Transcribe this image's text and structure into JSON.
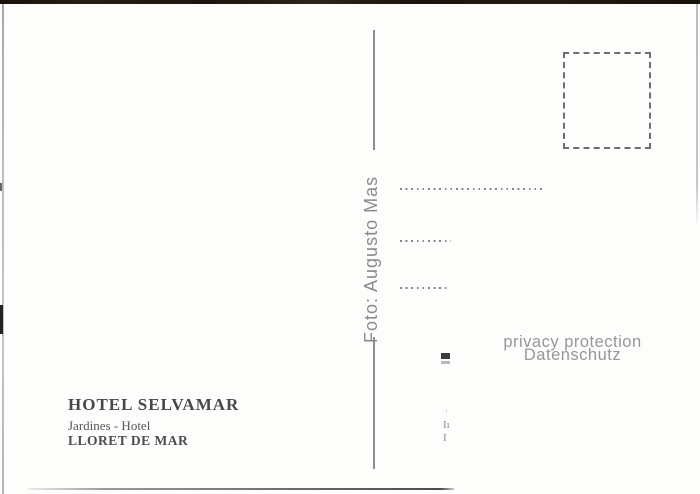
{
  "card": {
    "photographer_credit": "Foto: Augusto Mas",
    "watermark": {
      "line1": "privacy protection",
      "line2": "Datenschutz"
    },
    "caption": {
      "title": "HOTEL SELVAMAR",
      "subtitle": "Jardines - Hotel",
      "location": "LLORET DE MAR"
    },
    "edge_fragments": {
      "f1": "·",
      "f2": "Iı",
      "f3": "I"
    }
  },
  "colors": {
    "card_background": "#fdfdfc",
    "top_edge_dark": "#1d1911",
    "divider_gray": "#8d8d8d",
    "stamp_box_gray": "#6e6e6e",
    "dotted_line_gray": "#858585",
    "watermark_gray": "#979797",
    "caption_text": "#4c4c4c",
    "censor_mark": "#3d3d3d"
  }
}
